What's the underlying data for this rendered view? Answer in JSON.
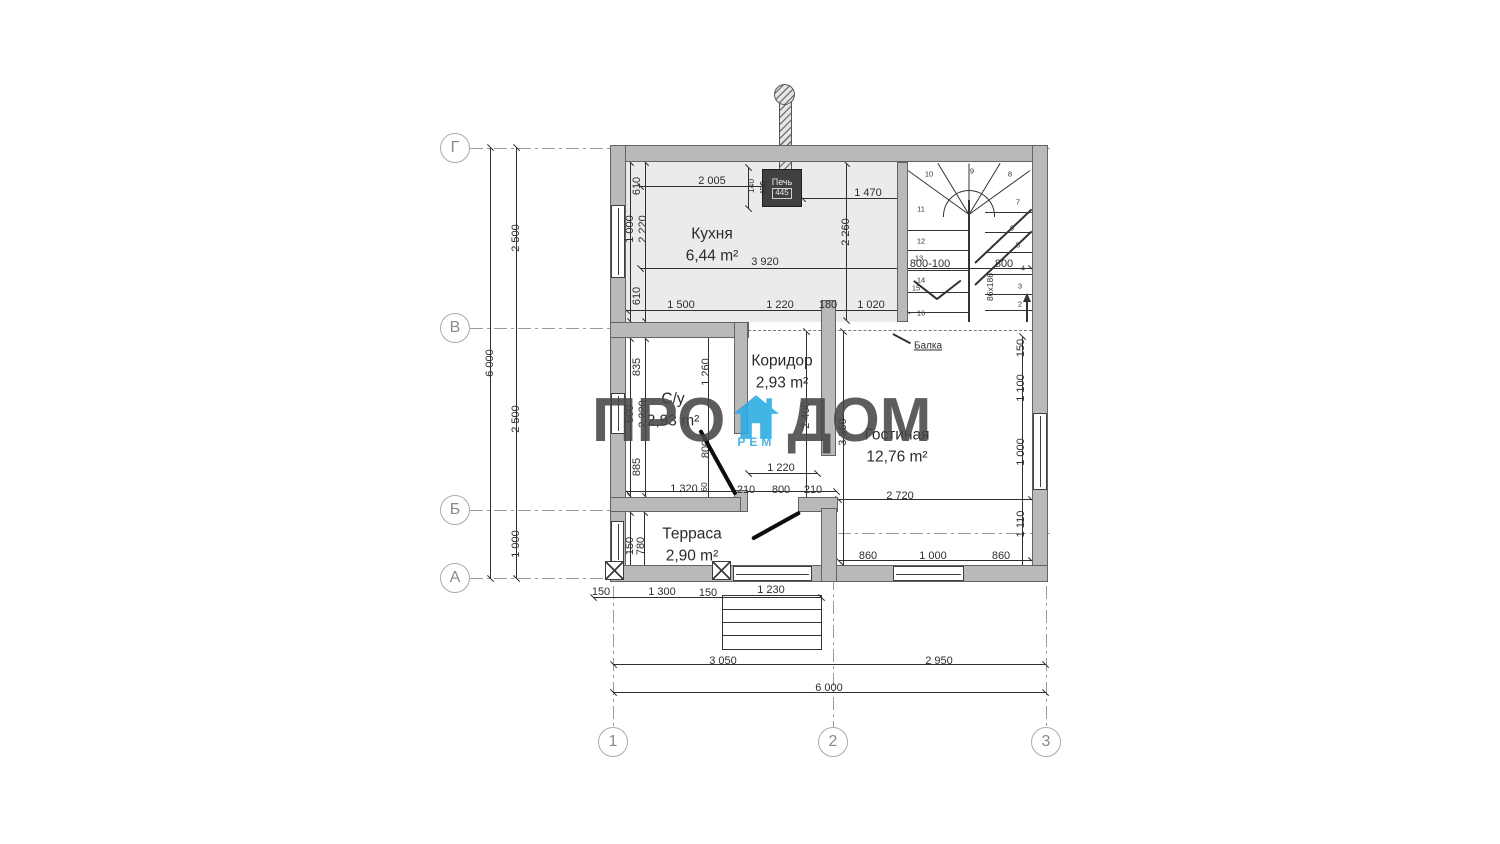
{
  "watermark": {
    "p1": "ПРО",
    "p2": "ДОМ",
    "sub": "РЕМ",
    "brand_color": "#29abe2",
    "text_color": "#474747"
  },
  "stove": {
    "label": "Печь",
    "code": "445"
  },
  "beam": {
    "label": "Балка"
  },
  "axis_rows": [
    {
      "label": "Г",
      "y": 148
    },
    {
      "label": "В",
      "y": 328
    },
    {
      "label": "Б",
      "y": 510
    },
    {
      "label": "А",
      "y": 578
    }
  ],
  "axis_cols": [
    {
      "label": "1",
      "x": 613
    },
    {
      "label": "2",
      "x": 833
    },
    {
      "label": "3",
      "x": 1046
    }
  ],
  "rooms": [
    {
      "name": "Кухня",
      "area": "6,44 m²",
      "x": 712,
      "y": 245
    },
    {
      "name": "Коридор",
      "area": "2,93 m²",
      "x": 782,
      "y": 372
    },
    {
      "name": "С/у",
      "area": "2,93 m²",
      "x": 673,
      "y": 410
    },
    {
      "name": "Гостиная",
      "area": "12,76 m²",
      "x": 897,
      "y": 446
    },
    {
      "name": "Терраса",
      "area": "2,90 m²",
      "x": 692,
      "y": 545
    }
  ],
  "dims": [
    {
      "t": "6 000",
      "x": 490,
      "y": 363,
      "v": 1
    },
    {
      "t": "2 500",
      "x": 516,
      "y": 238,
      "v": 1
    },
    {
      "t": "2 500",
      "x": 516,
      "y": 419,
      "v": 1
    },
    {
      "t": "1 000",
      "x": 516,
      "y": 544,
      "v": 1
    },
    {
      "t": "2 005",
      "x": 712,
      "y": 181
    },
    {
      "t": "140",
      "x": 751,
      "y": 186,
      "v": 1,
      "s": 1
    },
    {
      "t": "450",
      "x": 763,
      "y": 188,
      "v": 1,
      "s": 1
    },
    {
      "t": "1 470",
      "x": 868,
      "y": 193
    },
    {
      "t": "3 920",
      "x": 765,
      "y": 262
    },
    {
      "t": "2 260",
      "x": 846,
      "y": 232,
      "v": 1
    },
    {
      "t": "800-100",
      "x": 930,
      "y": 264
    },
    {
      "t": "800",
      "x": 1004,
      "y": 264
    },
    {
      "t": "610",
      "x": 637,
      "y": 186,
      "v": 1
    },
    {
      "t": "1 000",
      "x": 630,
      "y": 229,
      "v": 1
    },
    {
      "t": "2 220",
      "x": 643,
      "y": 229,
      "v": 1
    },
    {
      "t": "610",
      "x": 637,
      "y": 296,
      "v": 1
    },
    {
      "t": "1 500",
      "x": 681,
      "y": 305
    },
    {
      "t": "1 220",
      "x": 780,
      "y": 305
    },
    {
      "t": "180",
      "x": 828,
      "y": 305
    },
    {
      "t": "1 020",
      "x": 871,
      "y": 305
    },
    {
      "t": "835",
      "x": 637,
      "y": 367,
      "v": 1
    },
    {
      "t": "500",
      "x": 630,
      "y": 414,
      "v": 1
    },
    {
      "t": "2 220",
      "x": 643,
      "y": 414,
      "v": 1
    },
    {
      "t": "885",
      "x": 637,
      "y": 467,
      "v": 1
    },
    {
      "t": "1 260",
      "x": 706,
      "y": 372,
      "v": 1
    },
    {
      "t": "800",
      "x": 706,
      "y": 449,
      "v": 1
    },
    {
      "t": "60",
      "x": 704,
      "y": 487,
      "v": 1,
      "s": 1
    },
    {
      "t": "1 220",
      "x": 781,
      "y": 468
    },
    {
      "t": "1 320",
      "x": 684,
      "y": 489
    },
    {
      "t": "210",
      "x": 746,
      "y": 490
    },
    {
      "t": "800",
      "x": 781,
      "y": 490
    },
    {
      "t": "210",
      "x": 813,
      "y": 490
    },
    {
      "t": "2 400",
      "x": 806,
      "y": 415,
      "v": 1
    },
    {
      "t": "3 360",
      "x": 843,
      "y": 432,
      "v": 1
    },
    {
      "t": "2 720",
      "x": 900,
      "y": 496
    },
    {
      "t": "150",
      "x": 1021,
      "y": 348,
      "v": 1
    },
    {
      "t": "1 100",
      "x": 1021,
      "y": 388,
      "v": 1
    },
    {
      "t": "1 000",
      "x": 1021,
      "y": 452,
      "v": 1
    },
    {
      "t": "1 110",
      "x": 1021,
      "y": 524,
      "v": 1
    },
    {
      "t": "860",
      "x": 868,
      "y": 556
    },
    {
      "t": "1 000",
      "x": 933,
      "y": 556
    },
    {
      "t": "860",
      "x": 1001,
      "y": 556
    },
    {
      "t": "150",
      "x": 630,
      "y": 546,
      "v": 1
    },
    {
      "t": "780",
      "x": 641,
      "y": 546,
      "v": 1
    },
    {
      "t": "150",
      "x": 601,
      "y": 592
    },
    {
      "t": "1 300",
      "x": 662,
      "y": 592
    },
    {
      "t": "150",
      "x": 708,
      "y": 593
    },
    {
      "t": "1 230",
      "x": 771,
      "y": 590
    },
    {
      "t": "3 050",
      "x": 723,
      "y": 661
    },
    {
      "t": "2 950",
      "x": 939,
      "y": 661
    },
    {
      "t": "6 000",
      "x": 829,
      "y": 688
    },
    {
      "t": "86x186",
      "x": 990,
      "y": 287,
      "v": 1,
      "s": 1
    }
  ],
  "stairs": {
    "dim_left": "800-100",
    "dim_right": "800",
    "steps": [
      {
        "n": "11",
        "x": 921,
        "y": 209
      },
      {
        "n": "12",
        "x": 921,
        "y": 241
      },
      {
        "n": "13",
        "x": 919,
        "y": 258
      },
      {
        "n": "14",
        "x": 921,
        "y": 280
      },
      {
        "n": "15",
        "x": 916,
        "y": 288
      },
      {
        "n": "16",
        "x": 921,
        "y": 313
      },
      {
        "n": "10",
        "x": 929,
        "y": 174
      },
      {
        "n": "9",
        "x": 972,
        "y": 171
      },
      {
        "n": "8",
        "x": 1010,
        "y": 174
      },
      {
        "n": "7",
        "x": 1018,
        "y": 202
      },
      {
        "n": "6",
        "x": 1012,
        "y": 228
      },
      {
        "n": "5",
        "x": 1018,
        "y": 245
      },
      {
        "n": "4",
        "x": 1023,
        "y": 268
      },
      {
        "n": "3",
        "x": 1020,
        "y": 286
      },
      {
        "n": "2",
        "x": 1020,
        "y": 304
      }
    ]
  }
}
